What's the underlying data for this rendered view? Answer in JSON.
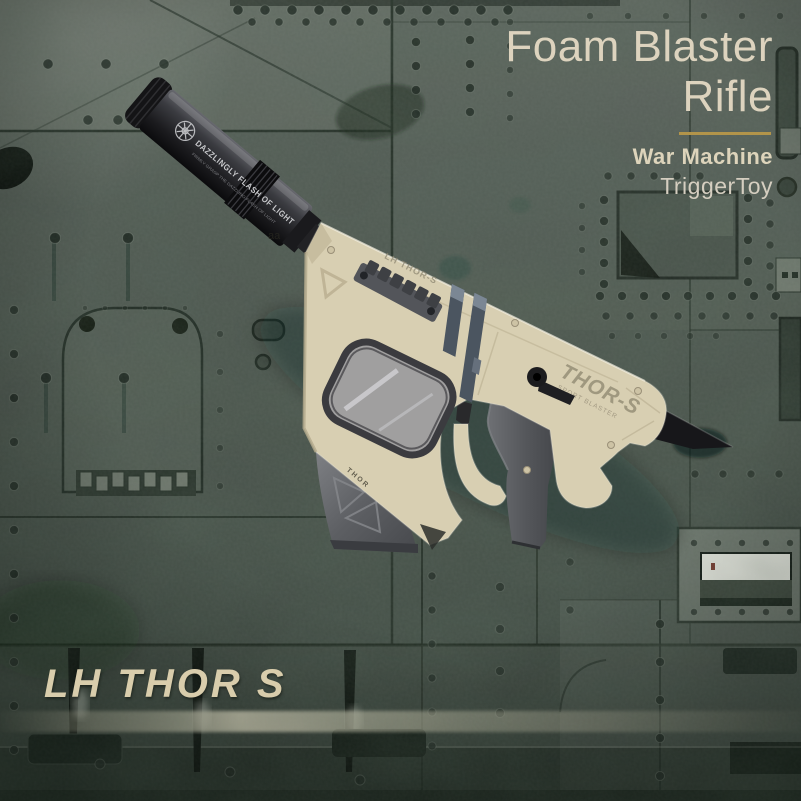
{
  "header": {
    "title_line1": "Foam Blaster",
    "title_line2": "Rifle",
    "brand": "War Machine",
    "maker": "TriggerToy"
  },
  "footer": {
    "model_name": "LH THOR S"
  },
  "blaster": {
    "suppressor_marking": "DAZZLINGLY FLASH OF LIGHT",
    "suppressor_submarking": "FIRMLY GRASP THE DAZZLING FLASH OF LIGHT",
    "receiver_marking": "LH THOR-S",
    "stock_marking": "THOR-S",
    "stock_submarking": "SPORT BLASTER",
    "magwell_marking": "THOR",
    "wall_marking": "aa"
  },
  "colors": {
    "accent_gold": "#b2944a",
    "title_cream": "#ddd3be",
    "body_tan": "#d8cfb2",
    "metal_green": "#4a544c"
  }
}
